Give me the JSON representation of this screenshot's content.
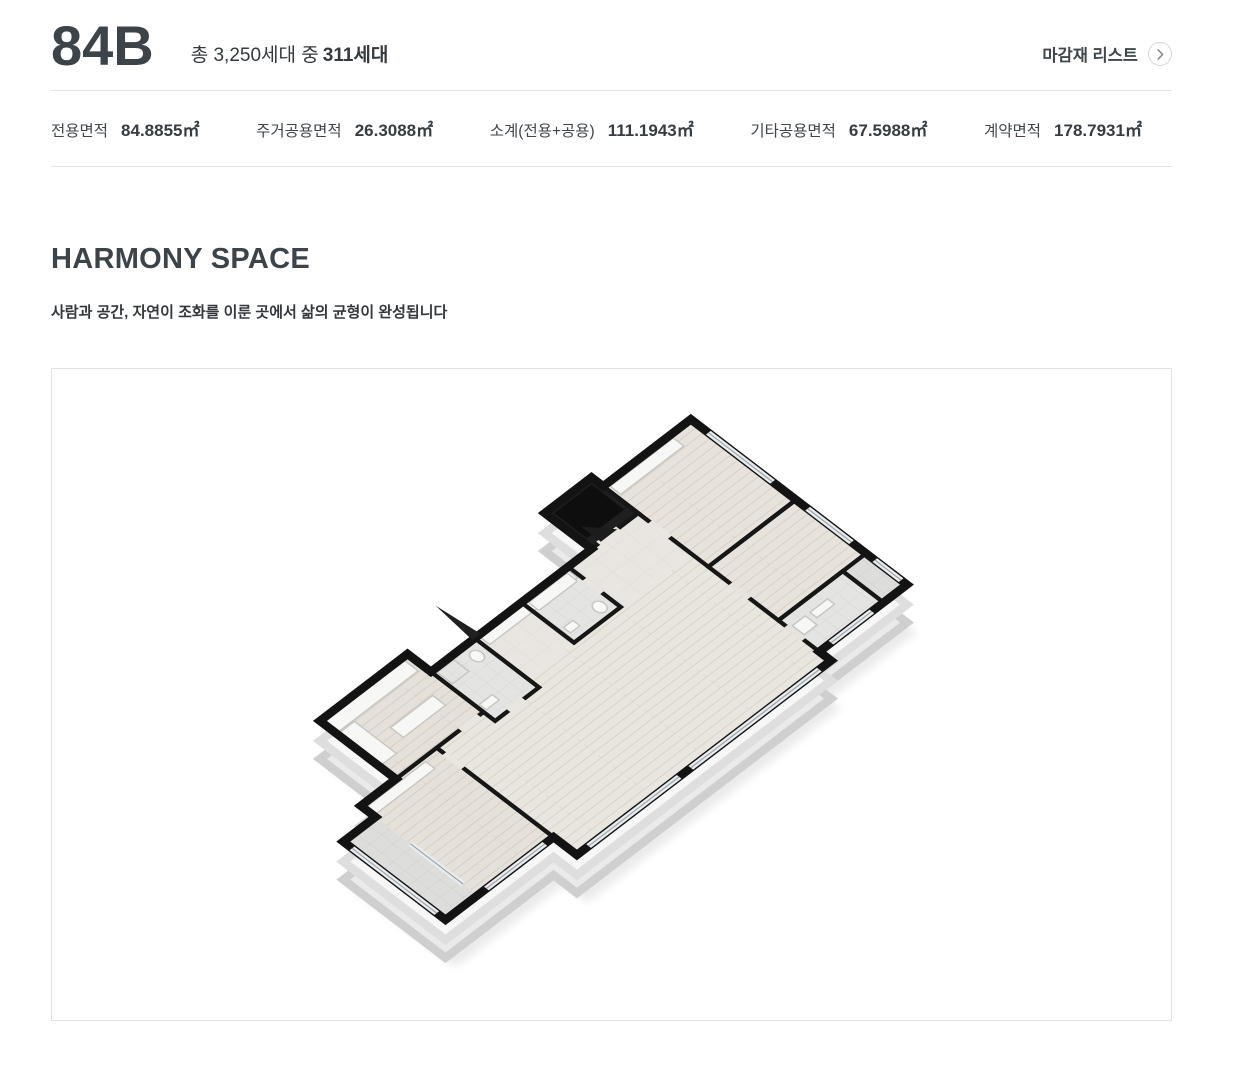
{
  "header": {
    "unit_type": "84B",
    "household_prefix": "총 3,250세대 중",
    "household_strong": "311세대",
    "finish_list_label": "마감재 리스트",
    "finish_list_icon": "chevron-right-circle"
  },
  "area_stats": {
    "items": [
      {
        "label": "전용면적",
        "value": "84.8855㎡"
      },
      {
        "label": "주거공용면적",
        "value": "26.3088㎡"
      },
      {
        "label": "소계(전용+공용)",
        "value": "111.1943㎡"
      },
      {
        "label": "기타공용면적",
        "value": "67.5988㎡"
      },
      {
        "label": "계약면적",
        "value": "178.7931㎡"
      }
    ]
  },
  "harmony_section": {
    "title": "HARMONY SPACE",
    "subtitle": "사람과 공간, 자연이 조화를 이룬 곳에서 삶의 균형이 완성됩니다"
  },
  "floor_plan": {
    "style": "3d-isometric-render",
    "colors": {
      "wall_top": "#131313",
      "wall_side": "#f4f4f4",
      "wood_floor": "#e7e3dc",
      "tile_floor": "#e4e4e2",
      "stone_floor": "#e9e6e1",
      "balcony_tile": "#dddddb",
      "dark_vestibule": "#141414",
      "panel_border": "#e2e2e2",
      "text_dark": "#3d4449",
      "divider": "#e4e4e4"
    }
  }
}
